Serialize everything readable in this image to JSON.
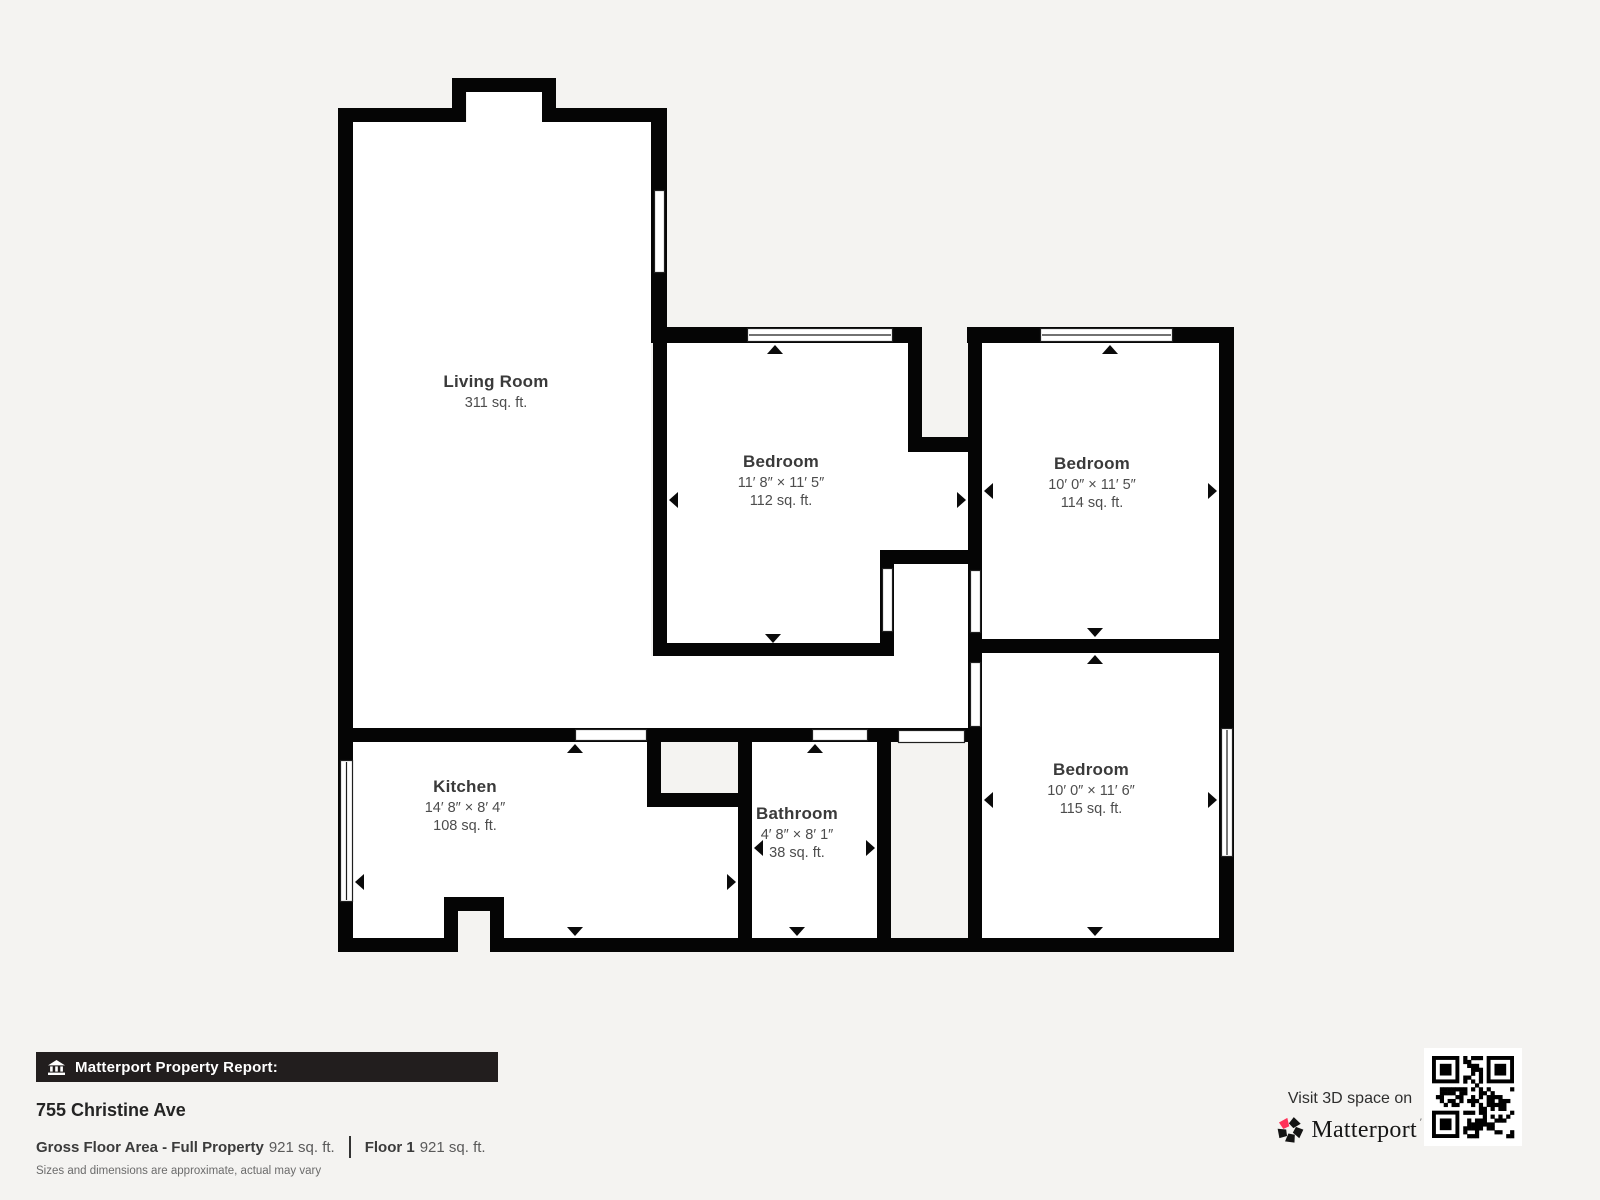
{
  "floor_plan": {
    "rooms": [
      {
        "id": "living-room",
        "name": "Living Room",
        "dimensions": "",
        "area": "311 sq. ft."
      },
      {
        "id": "bedroom-1",
        "name": "Bedroom",
        "dimensions": "11′ 8″ × 11′ 5″",
        "area": "112 sq. ft."
      },
      {
        "id": "bedroom-2",
        "name": "Bedroom",
        "dimensions": "10′ 0″ × 11′ 5″",
        "area": "114 sq. ft."
      },
      {
        "id": "bedroom-3",
        "name": "Bedroom",
        "dimensions": "10′ 0″ × 11′ 6″",
        "area": "115 sq. ft."
      },
      {
        "id": "kitchen",
        "name": "Kitchen",
        "dimensions": "14′ 8″ × 8′ 4″",
        "area": "108 sq. ft."
      },
      {
        "id": "bathroom",
        "name": "Bathroom",
        "dimensions": "4′ 8″ × 8′ 1″",
        "area": "38 sq. ft."
      }
    ]
  },
  "footer": {
    "report_label": "Matterport Property Report:",
    "address": "755 Christine Ave",
    "gross_floor_area_label": "Gross Floor Area - Full Property",
    "gross_floor_area_value": "921 sq. ft.",
    "floor_label": "Floor 1",
    "floor_value": "921 sq. ft.",
    "disclaimer": "Sizes and dimensions are approximate, actual may vary"
  },
  "promo": {
    "visit_text": "Visit 3D space on",
    "brand": "Matterport",
    "brand_mark": "′"
  },
  "colors": {
    "background": "#f4f3f1",
    "wall": "#050505",
    "room_fill": "#ffffff",
    "accent_pink": "#ff3158",
    "footer_bar": "#221e1e"
  }
}
